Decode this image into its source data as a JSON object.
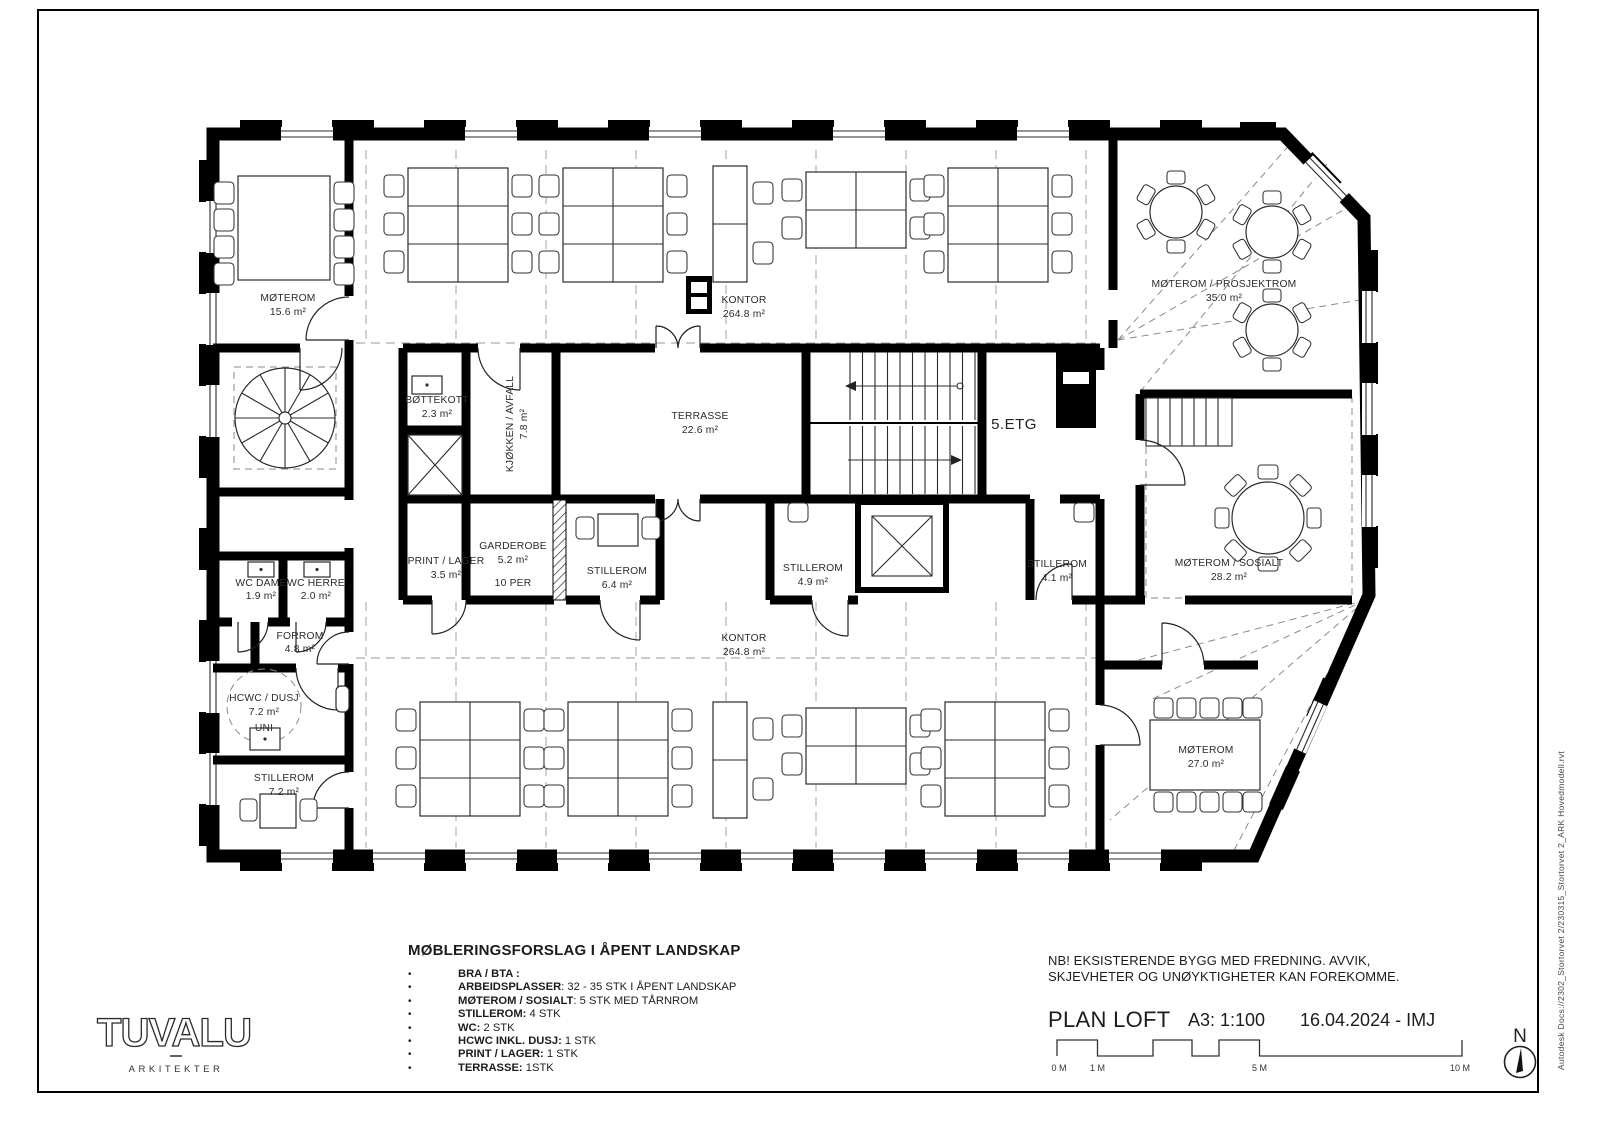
{
  "sheet": {
    "floor_label": "5.ETG",
    "frame_note": "Autodesk Docs://2302_Stortorvet 2/230315_Stortorvet 2_ARK Hovedmodell.rvt"
  },
  "logo": {
    "name": "TUVALU",
    "sub": "ARKITEKTER"
  },
  "legend": {
    "title": "MØBLERINGSFORSLAG I ÅPENT LANDSKAP",
    "bullet": "•",
    "items": [
      {
        "key": "BRA / BTA :",
        "value": ""
      },
      {
        "key": "ARBEIDSPLASSER",
        "value": ": 32 - 35 STK I ÅPENT LANDSKAP"
      },
      {
        "key": "MØTEROM / SOSIALT",
        "value": ": 5 STK MED TÅRNROM"
      },
      {
        "key": "STILLEROM:",
        "value": " 4 STK"
      },
      {
        "key": "WC:",
        "value": " 2 STK"
      },
      {
        "key": "HCWC INKL. DUSJ:",
        "value": " 1 STK"
      },
      {
        "key": "PRINT / LAGER:",
        "value": " 1 STK"
      },
      {
        "key": "TERRASSE:",
        "value": " 1STK"
      }
    ]
  },
  "titleblock": {
    "note_line1": "NB! EKSISTERENDE BYGG MED FREDNING.  AVVIK,",
    "note_line2": "SKJEVHETER OG UNØYKTIGHETER KAN FOREKOMME.",
    "plan_name": "PLAN LOFT",
    "scale": "A3: 1:100",
    "date_initials": "16.04.2024 - IMJ",
    "north_label": "N",
    "scalebar_labels": [
      "0 M",
      "1 M",
      "5 M",
      "10 M"
    ]
  },
  "rooms": [
    {
      "name": "MØTEROM",
      "area": "15.6 m²"
    },
    {
      "name": "KONTOR",
      "area": "264.8 m²"
    },
    {
      "name": "MØTEROM / PROSJEKTROM",
      "area": "35.0 m²"
    },
    {
      "name": "BØTTEKOTT",
      "area": "2.3 m²"
    },
    {
      "name": "KJØKKEN / AVFALL",
      "area": "7.8 m²"
    },
    {
      "name": "TERRASSE",
      "area": "22.6 m²"
    },
    {
      "name": "PRINT / LAGER",
      "area": "3.5 m²"
    },
    {
      "name": "GARDEROBE",
      "area": "5.2 m²",
      "extra": "10 PER"
    },
    {
      "name": "STILLEROM",
      "area": "6.4 m²"
    },
    {
      "name": "STILLEROM",
      "area": "4.9 m²"
    },
    {
      "name": "STILLEROM",
      "area": "4.1 m²"
    },
    {
      "name": "MØTEROM / SOSIALT",
      "area": "28.2 m²"
    },
    {
      "name": "WC DAME",
      "area": "1.9 m²"
    },
    {
      "name": "WC HERRE",
      "area": "2.0 m²"
    },
    {
      "name": "FORROM",
      "area": "4.8 m²"
    },
    {
      "name": "HCWC / DUSJ",
      "area": "7.2 m²",
      "extra": "UNI"
    },
    {
      "name": "STILLEROM",
      "area": "7.2 m²"
    },
    {
      "name": "KONTOR",
      "area": "264.8 m²"
    },
    {
      "name": "MØTEROM",
      "area": "27.0 m²"
    }
  ]
}
